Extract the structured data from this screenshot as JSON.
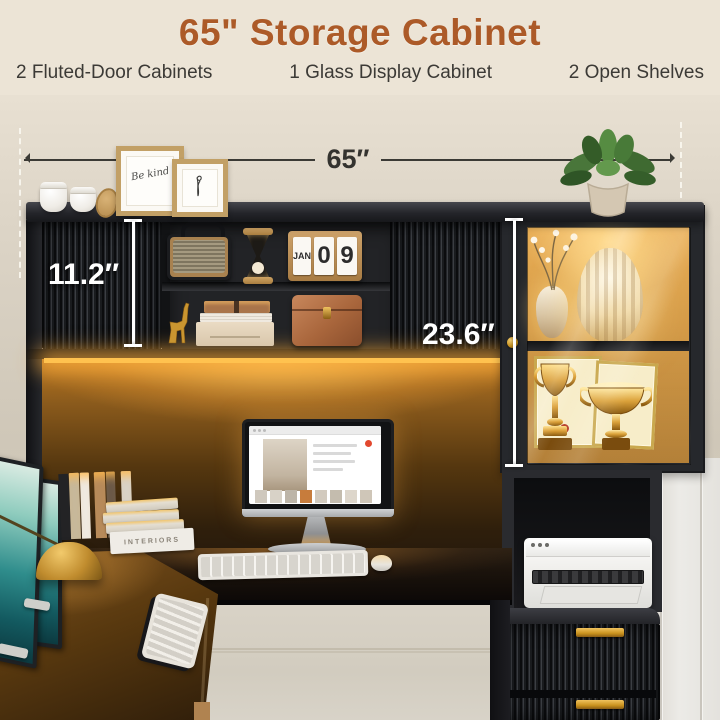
{
  "header": {
    "title": "65\" Storage Cabinet",
    "features": [
      "2 Fluted-Door Cabinets",
      "1 Glass Display Cabinet",
      "2 Open Shelves"
    ]
  },
  "dimensions": {
    "overall_width": "65″",
    "upper_cabinet": "11.2″",
    "display_cabinet": "23.6″"
  },
  "decor": {
    "calendar_month": "JAN",
    "calendar_day_tens": "0",
    "calendar_day_ones": "9",
    "book_spine": "INTERIORS",
    "frame_art_text": "Be kind"
  },
  "colors": {
    "title_accent": "#AC5A28",
    "subtitle_text": "#3C3A36",
    "background_cream": "#ECE4D6",
    "wall_beige": "#D8D0C2",
    "cabinet_black": "#1E1F22",
    "led_glow_amber": "#FFC24F",
    "gold_hardware": "#C9921E",
    "dimension_dark": "#34332F",
    "dimension_light": "#FFFFFF"
  }
}
